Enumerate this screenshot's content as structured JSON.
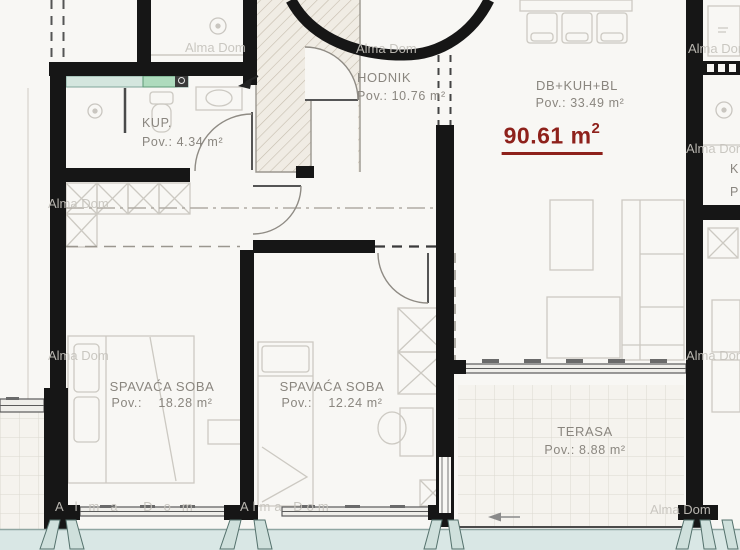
{
  "plan": {
    "total": {
      "value": "90.61 m",
      "sup": "2"
    },
    "rooms": {
      "kup": {
        "name": "KUP.",
        "area": "Pov.: 4.34 m²"
      },
      "hodnik": {
        "name": "HODNIK",
        "area": "Pov.: 10.76 m²"
      },
      "living": {
        "name": "DB+KUH+BL",
        "area": "Pov.: 33.49 m²"
      },
      "bedroom1": {
        "name": "SPAVAĆA SOBA",
        "area": "Pov.:    18.28 m²"
      },
      "bedroom2": {
        "name": "SPAVAĆA SOBA",
        "area": "Pov.:    12.24 m²"
      },
      "terrace": {
        "name": "TERASA",
        "area": "Pov.: 8.88 m²"
      }
    },
    "neighbor": {
      "k": "K",
      "p": "P"
    },
    "watermark": "Alma Dom",
    "colors": {
      "accent_red": "#8e211b",
      "wall": "#161616",
      "teal_band": "#d9e7e5"
    }
  }
}
